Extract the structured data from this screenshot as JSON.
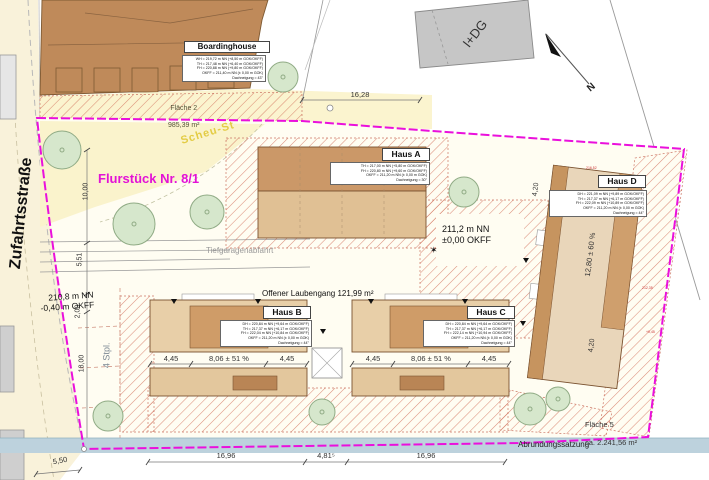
{
  "streets": {
    "zufahrt": "Zufahrtsstraße",
    "scheu": "Scheu-St",
    "abrundung": "Abrundungssatzung"
  },
  "parcel": {
    "title": "Flurstück Nr. 8/1"
  },
  "areas": {
    "f2_name": "Fläche 2",
    "f2_size": "985,39 m²",
    "f5_name": "Fläche 5",
    "f5_size": "ca. 2.241,56 m²"
  },
  "buildings": {
    "boardinghouse": {
      "name": "Boardinghouse",
      "info": "WH = 219,72 m NN (+8,50 m GOK/OKFF)\nTH = 217,48 m NN (+6,40 m GOK/OKFF)\nFH = 220,88 m NN (+9,80 m GOK/OKFF)\nOKFF = 211,40 m NN (± 0,00 m GOK)\nDachneigung = 43°"
    },
    "haus_a": {
      "name": "Haus A",
      "info": "TH = 217,00 m NN (+5,80 m GOK/OKFF)\nFH = 220,80 m NN (+9,60 m GOK/OKFF)\nOKFF = 211,20 m NN (± 0,00 m GOK)\nDachneigung = 30°"
    },
    "haus_b": {
      "name": "Haus B",
      "info": "DH = 220,84 m NN (+9,64 m GOK/OKFF)\nTH = 217,37 m NN (+6,17 m GOK/OKFF)\nFH = 222,04 m NN (+10,84 m GOK/OKFF)\nOKFF = 211,20 m NN (± 0,00 m GOK)\nDachneigung = 44°"
    },
    "haus_c": {
      "name": "Haus C",
      "info": "DH = 220,84 m NN (+9,64 m GOK/OKFF)\nTH = 217,37 m NN (+6,17 m GOK/OKFF)\nFH = 222,14 m NN (+10,94 m GOK/OKFF)\nOKFF = 211,20 m NN (± 0,00 m GOK)\nDachneigung = 44°"
    },
    "haus_d": {
      "name": "Haus D",
      "info": "DH = 221,09 m NN (+9,89 m GOK/OKFF)\nTH = 217,37 m NN (+6,17 m GOK/OKFF)\nFH = 222,09 m NN (+10,89 m GOK/OKFF)\nOKFF = 211,20 m NN (± 0,00 m GOK)\nDachneigung = 44°"
    },
    "neighbor": {
      "label": "I+DG"
    }
  },
  "labels": {
    "laubengang": "Offener Laubengang 121,99 m²",
    "tiefgarage": "Tiefgaragenabfahrt",
    "level_site": "211,2 m NN\n±0,00 OKFF",
    "level_street": "210,8 m NN\n-0,40 m OKFF",
    "parking": "4 Stpl.",
    "north": "N"
  },
  "icons": {
    "survey_star": "✶"
  },
  "dims": {
    "top": "16,28",
    "bottom": [
      "16,96",
      "4,81⁵",
      "16,96"
    ],
    "bottom_left": "5,50",
    "left": [
      "10,00",
      "5,51",
      "2,00",
      "18,00"
    ],
    "row_b": [
      "4,45",
      "8,06 ± 51 %",
      "4,45"
    ],
    "row_c": [
      "4,45",
      "8,06 ± 51 %",
      "4,45"
    ],
    "d_len": "12,80 ± 60 %",
    "d_w_top": "4,20",
    "d_w_bottom": "4,20"
  },
  "marks": {
    "red": [
      "216,52",
      "212,35",
      "+0,45"
    ]
  },
  "colors": {
    "boundary_magenta": "#ea10dc",
    "hatch_red": "#d06a55",
    "building_brown": "#bf8a5a",
    "building_tan": "#e9d0a9",
    "street_cream": "#f9f2da",
    "band_blue": "#bdd2dd",
    "tree_green": "#d6e7cc",
    "street_label_yellow": "#e3cc45"
  }
}
